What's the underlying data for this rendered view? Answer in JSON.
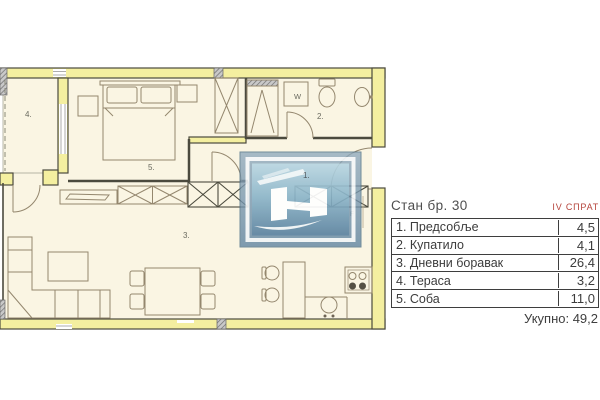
{
  "header": {
    "title": "Стан бр. 30",
    "floor": "IV СПРАТ"
  },
  "area_table": {
    "rows": [
      {
        "label": "1. Предсобље",
        "value": "4,5"
      },
      {
        "label": "2. Купатило",
        "value": "4,1"
      },
      {
        "label": "3. Дневни боравак",
        "value": "26,4"
      },
      {
        "label": "4. Тераса",
        "value": "3,2"
      },
      {
        "label": "5. Соба",
        "value": "11,0"
      }
    ],
    "total": "Укупно: 49,2"
  },
  "plan_labels": {
    "hallway": "1.",
    "bathroom": "2.",
    "living": "3.",
    "terrace": "4.",
    "bedroom": "5.",
    "washer": "W",
    "fridge": "F"
  },
  "colors": {
    "wall_fill": "#f4efa0",
    "floor_fill": "#faf5e3",
    "wall_line": "#4b4a3e",
    "furniture_line": "#94876e",
    "accent_red": "#b5443c",
    "logo_blue": "#5c82a0"
  }
}
